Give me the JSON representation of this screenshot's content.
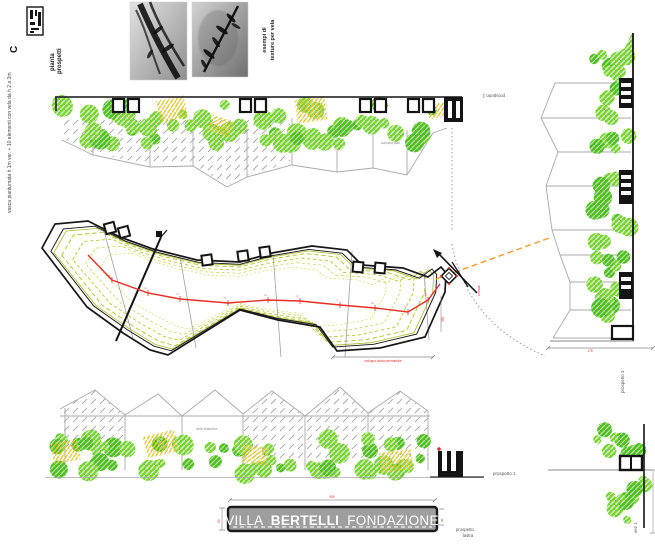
{
  "sheet": {
    "code": "C",
    "title_line1": "pianta",
    "title_line2": "prospetti",
    "side_note": "vasca piantumata  h 1m var. + 10 elementi con vela da h 2 a 3m"
  },
  "photos": {
    "caption_line1": "esempi di",
    "caption_line2": "texture per vela"
  },
  "elevations": {
    "top_label": "prospetto 2",
    "top_note": "vele bianche",
    "bottom_label": "prospetto 1",
    "bottom_note": "vele bianche",
    "right_label": "prospetto 3",
    "right_dim": "175"
  },
  "plan": {
    "entry_label": "entrata",
    "dim_note": "sviluppo lastra perimetrale",
    "side_dim": "350",
    "path_labels": [
      "1",
      "2",
      "3",
      "4",
      "5",
      "6",
      "7",
      "8",
      "9",
      "10"
    ]
  },
  "section": {
    "label": "sez 1"
  },
  "banner": {
    "word1": "VILLA",
    "word2": "BERTELLI",
    "word3": "FONDAZIONE",
    "dim_top": "550",
    "dim_left": "90",
    "dim_right": "90",
    "sublabel_line1": "prospetto",
    "sublabel_line2": "lastra"
  },
  "colors": {
    "green1": "#79d233",
    "green2": "#4fbd1f",
    "yellow": "#ddc83e",
    "contour": "#b7c32c",
    "red": "#e43026",
    "orange": "#f59b2e",
    "panel_gray": "#a8a8a8",
    "banner_gray": "#9e9e9e",
    "ink": "#141414"
  }
}
